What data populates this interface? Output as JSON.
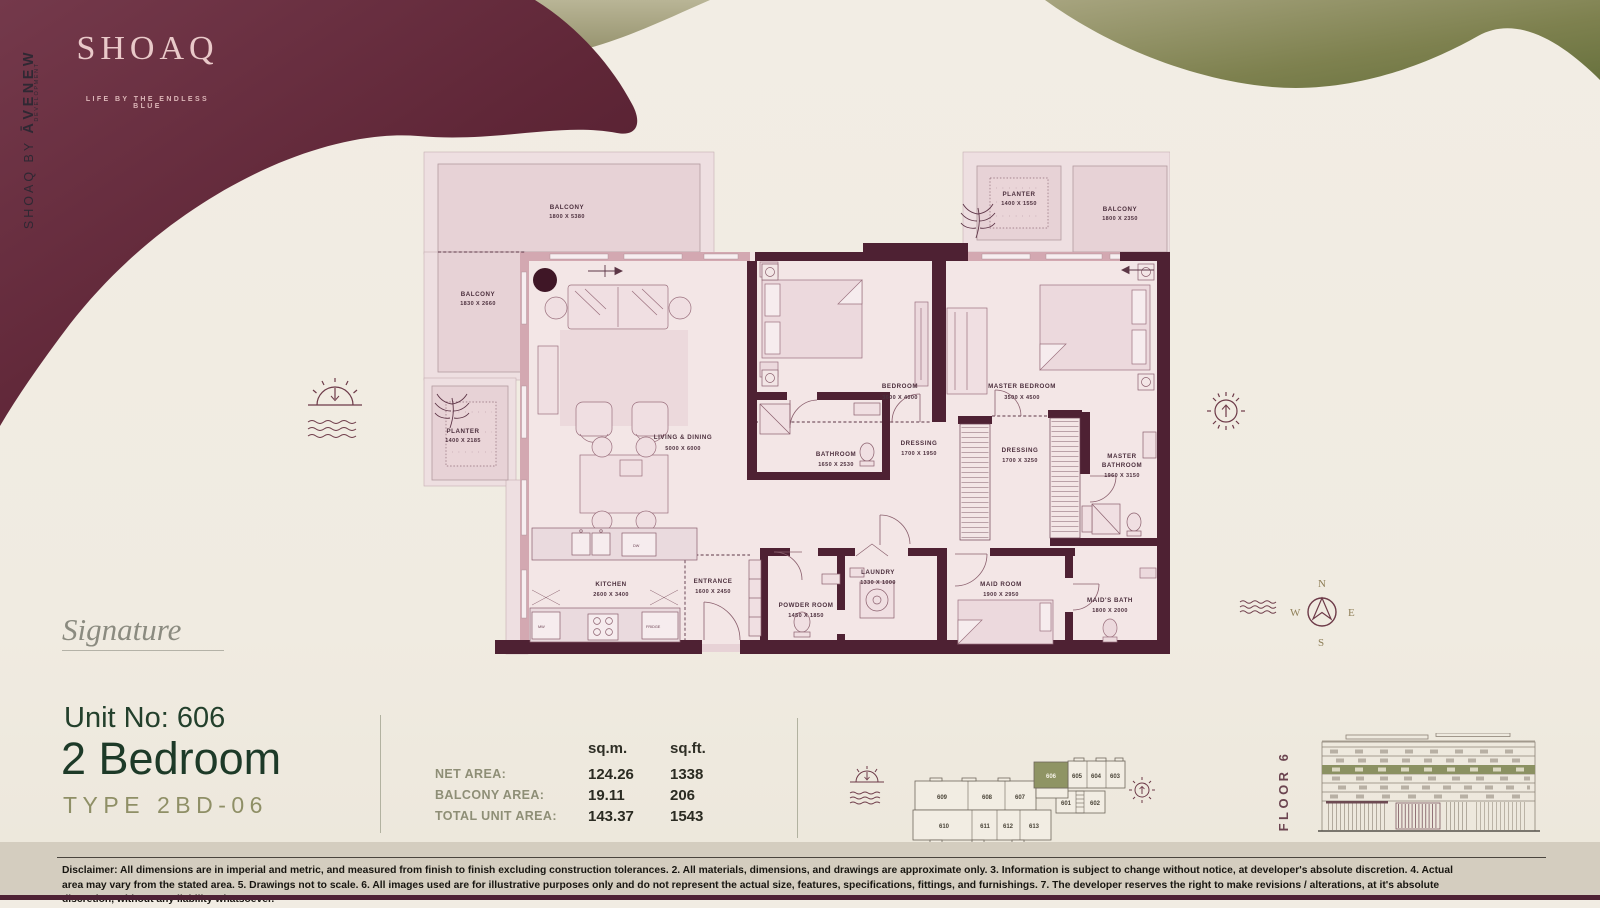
{
  "brand": {
    "logo": "SHOAQ",
    "tagline": "LIFE BY THE ENDLESS BLUE",
    "side_prefix": "SHOAQ BY ",
    "side_name": "ĀVENEW",
    "side_dev": "DEVELOPMENT"
  },
  "plan": {
    "rooms": {
      "balcony_top": {
        "name": "BALCONY",
        "dims": "1800 X 5380"
      },
      "balcony_left": {
        "name": "BALCONY",
        "dims": "1830 X 2660"
      },
      "planter_left": {
        "name": "PLANTER",
        "dims": "1400 X 2185"
      },
      "planter_right": {
        "name": "PLANTER",
        "dims": "1400 X 1550"
      },
      "balcony_right": {
        "name": "BALCONY",
        "dims": "1800 X 2350"
      },
      "living": {
        "name": "LIVING & DINING",
        "dims": "5000 X 6000"
      },
      "bedroom": {
        "name": "BEDROOM",
        "dims": "3600 X 4000"
      },
      "master_bedroom": {
        "name": "MASTER BEDROOM",
        "dims": "3500 X 4500"
      },
      "bathroom": {
        "name": "BATHROOM",
        "dims": "1650 X 2530"
      },
      "dressing1": {
        "name": "DRESSING",
        "dims": "1700 X 1950"
      },
      "dressing2": {
        "name": "DRESSING",
        "dims": "1700 X 3250"
      },
      "master_bathroom": {
        "name1": "MASTER",
        "name2": "BATHROOM",
        "dims": "1960 X 3150"
      },
      "kitchen": {
        "name": "KITCHEN",
        "dims": "2600 X 3400"
      },
      "entrance": {
        "name": "ENTRANCE",
        "dims": "1600 X 2450"
      },
      "powder": {
        "name": "POWDER ROOM",
        "dims": "1450 X 1850"
      },
      "laundry": {
        "name": "LAUNDRY",
        "dims": "1330 X 1000"
      },
      "maid_room": {
        "name": "MAID ROOM",
        "dims": "1900 X 2950"
      },
      "maid_bath": {
        "name": "MAID'S BATH",
        "dims": "1800 X 2000"
      }
    },
    "appliances": {
      "mw": "MW",
      "fridge": "FRIDGE",
      "dw": "DW"
    }
  },
  "unit": {
    "signature": "Signature",
    "unit_no": "Unit No: 606",
    "bedrooms": "2 Bedroom",
    "type": "TYPE 2BD-06"
  },
  "areas": {
    "col_sqm": "sq.m.",
    "col_sqft": "sq.ft.",
    "rows": [
      {
        "label": "NET AREA:",
        "sqm": "124.26",
        "sqft": "1338"
      },
      {
        "label": "BALCONY AREA:",
        "sqm": "19.11",
        "sqft": "206"
      },
      {
        "label": "TOTAL UNIT AREA:",
        "sqm": "143.37",
        "sqft": "1543"
      }
    ]
  },
  "keyplan": {
    "highlight": "606",
    "units": {
      "u601": "601",
      "u602": "602",
      "u603": "603",
      "u604": "604",
      "u605": "605",
      "u607": "607",
      "u608": "608",
      "u609": "609",
      "u610": "610",
      "u611": "611",
      "u612": "612",
      "u613": "613"
    }
  },
  "floor_label": "FLOOR 6",
  "compass": {
    "n": "N",
    "e": "E",
    "s": "S",
    "w": "W"
  },
  "disclaimer": "Disclaimer: All dimensions are in imperial and metric, and measured from finish to finish excluding construction tolerances. 2. All materials, dimensions, and drawings are approximate only. 3. Information is subject to change without notice, at developer's absolute discretion. 4. Actual area may vary from the stated area. 5. Drawings not to scale. 6. All images used are for illustrative purposes only and do not represent the actual size, features, specifications, fittings, and furnishings. 7. The developer reserves the right to make revisions / alterations, at it's absolute discretion, without any liability whatsoever.",
  "colors": {
    "background": "#f1ece3",
    "maroon_wave": "#5f2637",
    "olive_wave": "#8f8c68",
    "wall": "#4e2133",
    "floor": "#f3e6e6",
    "balcony": "#e7d2d6",
    "heading_green": "#1d3a28",
    "type_olive": "#8f8f66",
    "highlight_unit": "#8f9464"
  }
}
